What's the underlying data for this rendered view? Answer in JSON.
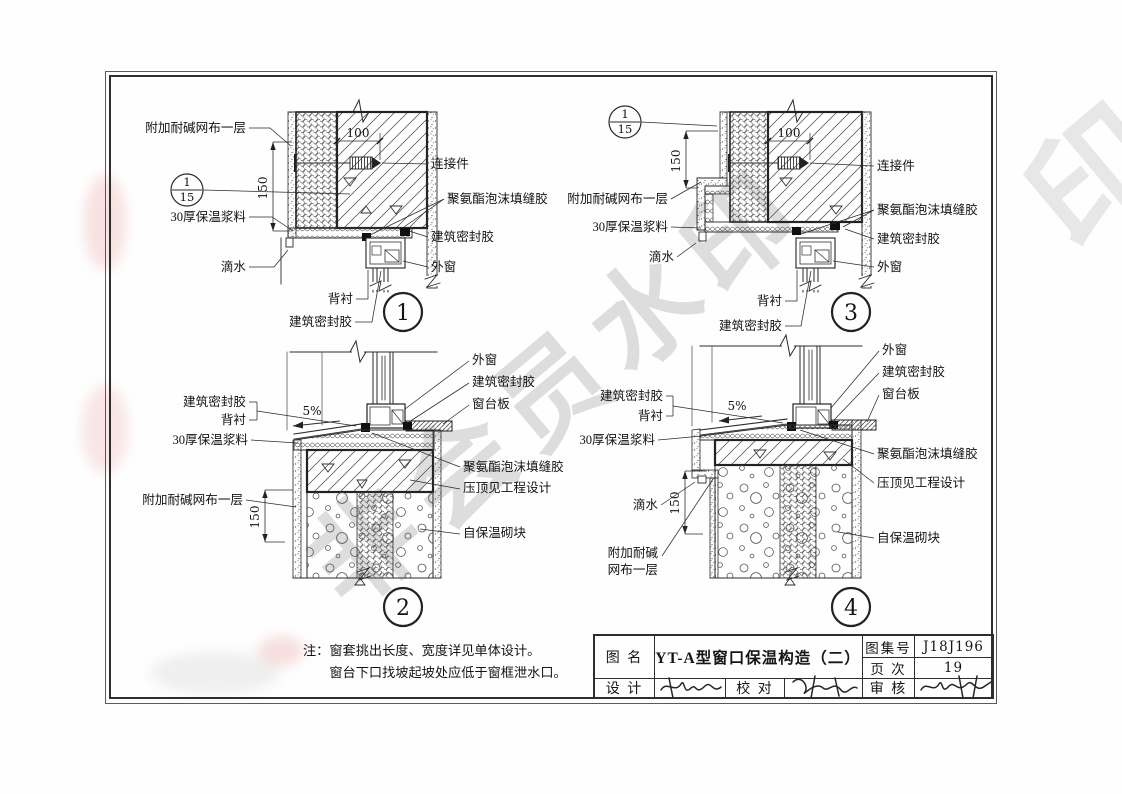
{
  "sheet": {
    "watermark": "非会员水印",
    "watermark_corner": "印",
    "note": {
      "label": "注：",
      "line1": "窗套挑出长度、宽度详见单体设计。",
      "line2": "窗台下口找坡起坡处应低于窗框泄水口。"
    }
  },
  "title_block": {
    "name_label": "图 名",
    "drawing_title": "YT-A型窗口保温构造（二）",
    "atlas_label": "图集号",
    "atlas_value": "J18J196",
    "page_label": "页 次",
    "page_value": "19",
    "design_label": "设 计",
    "proof_label": "校 对",
    "audit_label": "审 核"
  },
  "terms": {
    "mesh": "附加耐碱网布一层",
    "mesh_a": "附加耐碱",
    "mesh_b": "网布一层",
    "mortar30": "30厚保温浆料",
    "drip": "滴水",
    "backing": "背衬",
    "sealant": "建筑密封胶",
    "connector": "连接件",
    "pu_foam": "聚氨酯泡沫填缝胶",
    "window": "外窗",
    "sill_board": "窗台板",
    "coping": "压顶见工程设计",
    "block": "自保温砌块",
    "slope": "5%",
    "dim100": "100",
    "dim150": "150"
  },
  "details": {
    "ref": {
      "top": "1",
      "bottom": "15"
    },
    "d1": {
      "number": "1"
    },
    "d2": {
      "number": "2"
    },
    "d3": {
      "number": "3"
    },
    "d4": {
      "number": "4"
    }
  }
}
